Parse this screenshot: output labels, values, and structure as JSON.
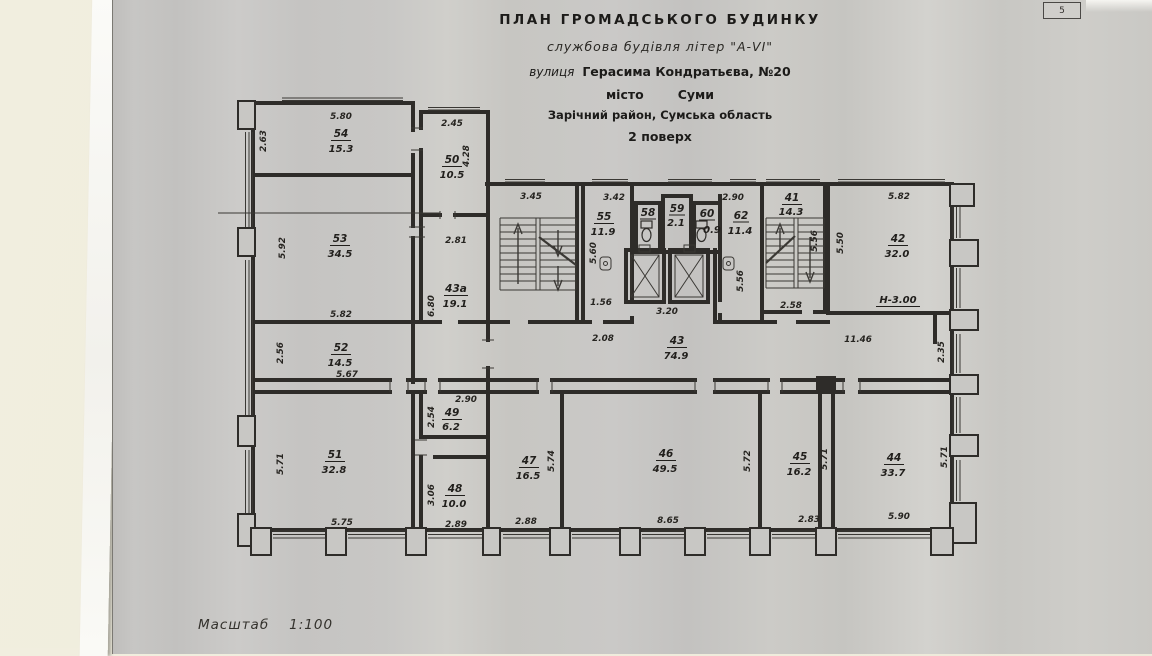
{
  "page": {
    "corner_number": "5"
  },
  "title_block": {
    "line1": "ПЛАН  ГРОМАДСЬКОГО  БУДИНКУ",
    "line2": "службова будівля літер \"А-VI\"",
    "street_label": "вулиця",
    "street_value": "Герасима Кондратьєва, №20",
    "city_label": "місто",
    "city_value": "Суми",
    "district": "Зарічний район, Сумська область",
    "floor": "2 поверх"
  },
  "scale": {
    "label": "Масштаб",
    "value": "1:100"
  },
  "notes": {
    "height_mark": "Н-3.00"
  },
  "rooms": {
    "r54": {
      "number": "54",
      "area": "15.3"
    },
    "r50": {
      "number": "50",
      "area": "10.5"
    },
    "r53": {
      "number": "53",
      "area": "34.5"
    },
    "r43a": {
      "number": "43а",
      "area": "19.1"
    },
    "r52": {
      "number": "52",
      "area": "14.5"
    },
    "r51": {
      "number": "51",
      "area": "32.8"
    },
    "r49": {
      "number": "49",
      "area": "6.2"
    },
    "r48": {
      "number": "48",
      "area": "10.0"
    },
    "r55": {
      "number": "55",
      "area": "11.9"
    },
    "r58": {
      "number": "58"
    },
    "r59": {
      "number": "59",
      "area": "2.1"
    },
    "r60": {
      "number": "60",
      "area": "0.9"
    },
    "r62": {
      "number": "62",
      "area": "11.4"
    },
    "r41": {
      "number": "41",
      "area": "14.3"
    },
    "r42": {
      "number": "42",
      "area": "32.0"
    },
    "r43": {
      "number": "43",
      "area": "74.9"
    },
    "r47": {
      "number": "47",
      "area": "16.5"
    },
    "r46": {
      "number": "46",
      "area": "49.5"
    },
    "r45": {
      "number": "45",
      "area": "16.2"
    },
    "r44": {
      "number": "44",
      "area": "33.7"
    }
  },
  "dims": {
    "d54_top": "5.80",
    "d54_left": "2.63",
    "d50_top": "2.45",
    "d50_right": "4.28",
    "d53_left": "5.92",
    "d53_bottom": "5.82",
    "d43a_top": "2.81",
    "d43a_left": "6.80",
    "d52_left": "2.56",
    "d52_bottom": "5.67",
    "d51_left": "5.71",
    "d51_bottom": "5.75",
    "d49_top": "2.90",
    "d49_left": "2.54",
    "d48_left": "3.06",
    "d48_bottom": "2.89",
    "d_stair_l_top": "3.45",
    "d55_top": "3.42",
    "d55_left": "5.60",
    "d55_bottom": "1.56",
    "d_corr_left": "2.08",
    "d_lobby": "3.20",
    "d62_top": "2.90",
    "d62_left": "5.56",
    "d_stair_r": "5.56",
    "d41_bottom": "2.58",
    "d42_top": "5.82",
    "d42_left": "5.50",
    "d_corr_right": "11.46",
    "d_corr_end": "2.35",
    "d47_right": "5.74",
    "d47_bottom": "2.88",
    "d46_right": "5.72",
    "d46_bottom": "8.65",
    "d45_right": "5.71",
    "d45_bottom": "2.83",
    "d44_right": "5.71",
    "d44_bottom": "5.90"
  }
}
